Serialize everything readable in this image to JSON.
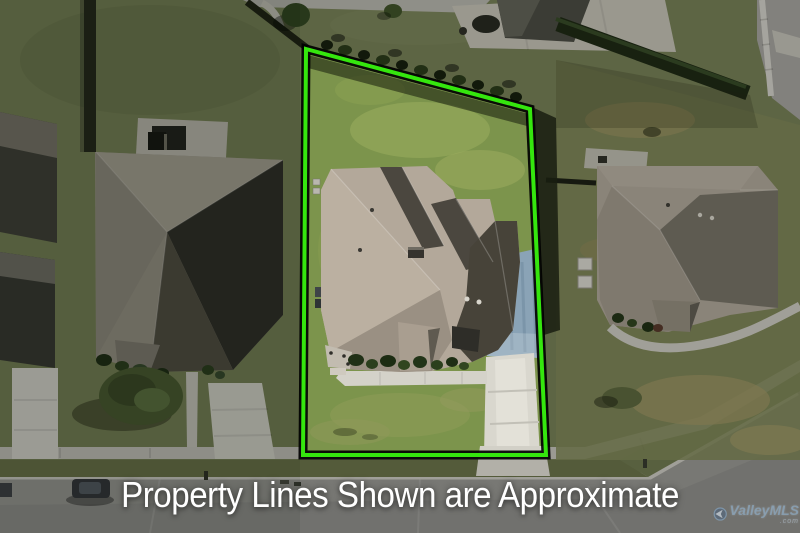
{
  "caption": {
    "text": "Property Lines Shown are Approximate",
    "color": "#ffffff"
  },
  "watermark": {
    "brand": "ValleyMLS",
    "suffix": ".com",
    "color": "#8fc1e8"
  },
  "property_boundary": {
    "line_color": "#35e60e",
    "outline_color": "#000000",
    "shape": "quadrilateral around subject lot"
  },
  "scene": {
    "view": "top-down aerial drone photo of a suburban residential lot",
    "features": [
      "subject house with tan shingle hip-and-gable roof",
      "bright green lawn inside outlined boundary",
      "white concrete driveway and front walkway to street",
      "blue-gray stained parking pad beside garage",
      "hedgerow and fence along rear boundary",
      "left neighbor house with dark charcoal roof and front-yard tree",
      "right neighbor house with gray roof and curved walkway",
      "rear neighbor patio and house at top",
      "street with sidewalk and grass strip across bottom",
      "dark vehicle parked at lower left curb"
    ]
  }
}
